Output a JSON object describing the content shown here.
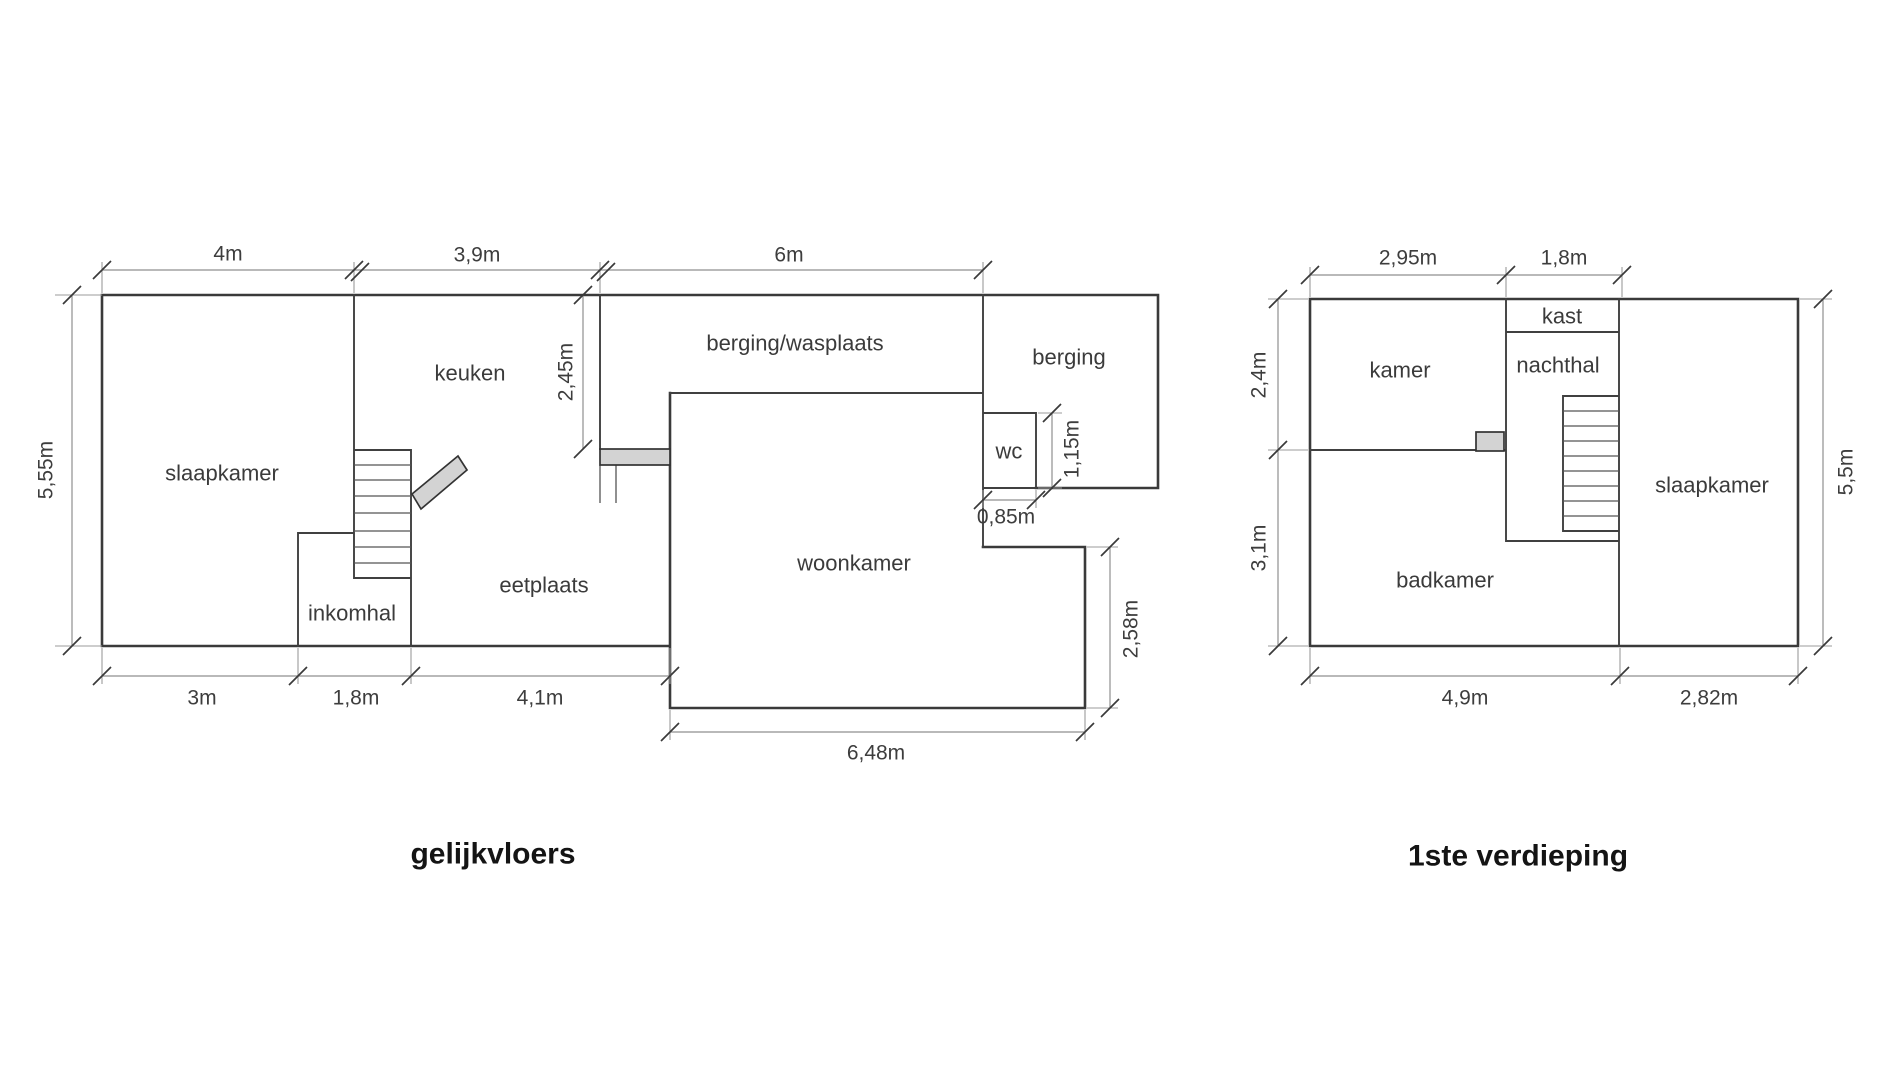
{
  "ground_floor": {
    "title": "gelijkvloers",
    "rooms": {
      "slaapkamer": "slaapkamer",
      "keuken": "keuken",
      "berging_wasplaats": "berging/wasplaats",
      "berging": "berging",
      "wc": "wc",
      "eetplaats": "eetplaats",
      "inkomhal": "inkomhal",
      "woonkamer": "woonkamer"
    },
    "dims": {
      "width_slaapkamer": "4m",
      "width_keuken": "3,9m",
      "width_berging_wasplaats": "6m",
      "height_total": "5,55m",
      "height_wasplaats": "2,45m",
      "height_wc": "1,15m",
      "width_wc": "0,85m",
      "height_woonkamer_ext": "2,58m",
      "bottom_slaapkamer": "3m",
      "bottom_inkomhal": "1,8m",
      "bottom_eetplaats": "4,1m",
      "width_woonkamer": "6,48m"
    }
  },
  "first_floor": {
    "title": "1ste verdieping",
    "rooms": {
      "kamer": "kamer",
      "kast": "kast",
      "nachthal": "nachthal",
      "slaapkamer": "slaapkamer",
      "badkamer": "badkamer"
    },
    "dims": {
      "width_kamer": "2,95m",
      "width_nachthal": "1,8m",
      "height_kamer": "2,4m",
      "height_badkamer": "3,1m",
      "height_total": "5,5m",
      "bottom_left": "4,9m",
      "bottom_right": "2,82m"
    }
  },
  "colors": {
    "background": "#ffffff",
    "walls": "#3a3a3a",
    "dimension_lines": "#8f8f8f",
    "door_fill": "#d3d3d3",
    "text": "#3b3b3b"
  }
}
